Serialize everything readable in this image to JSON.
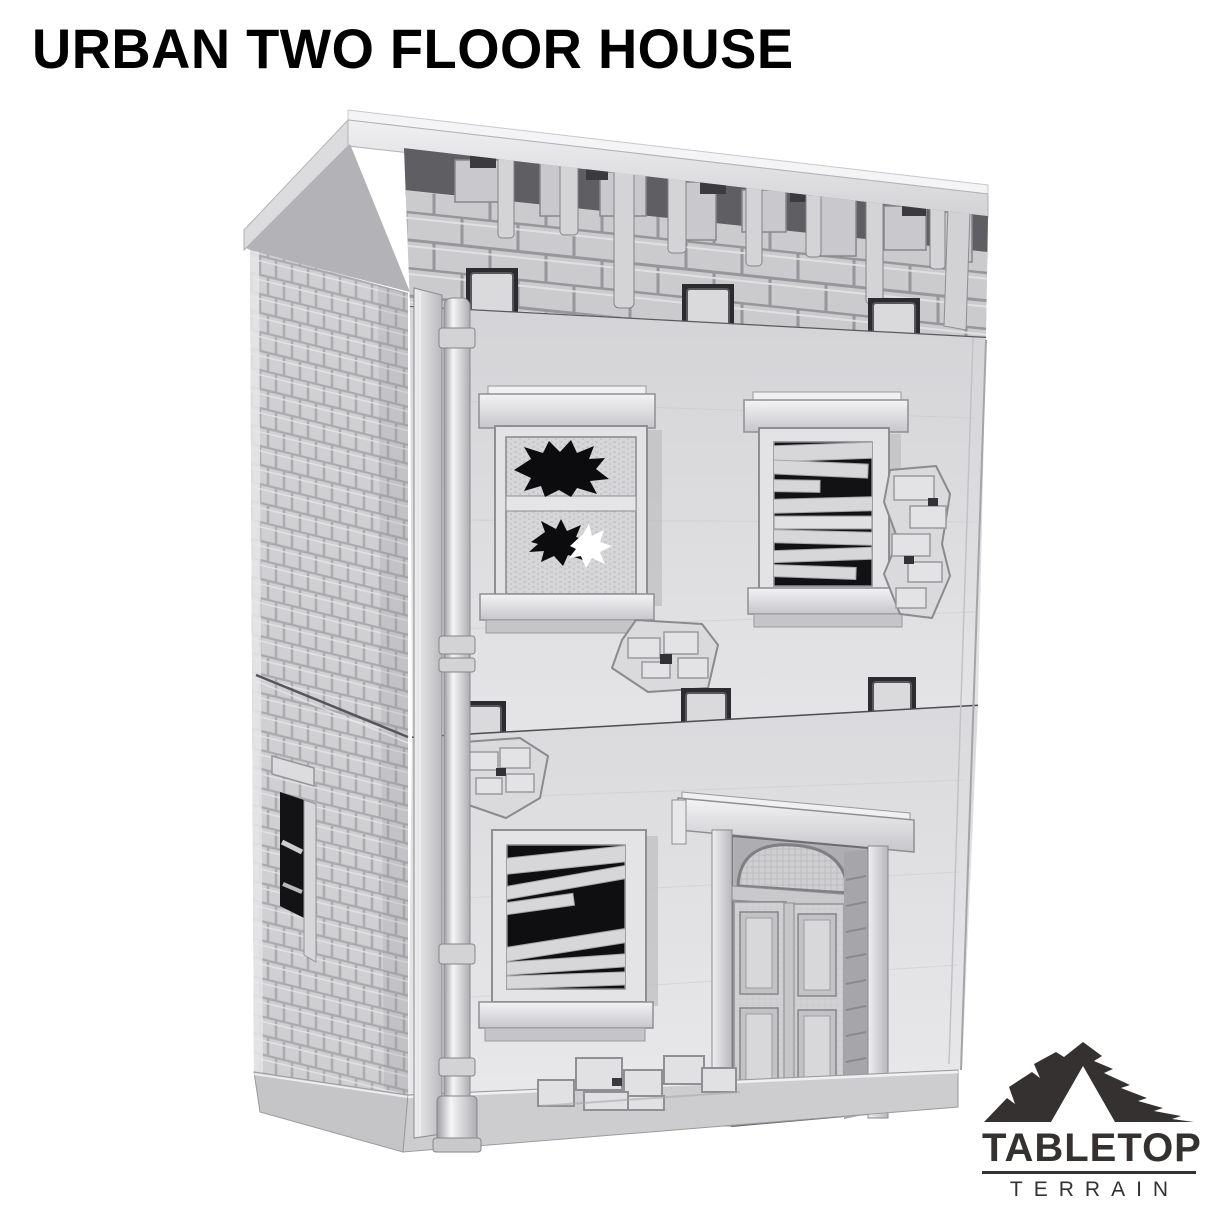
{
  "page": {
    "background_color": "#ffffff",
    "width": 1214,
    "height": 1214
  },
  "title": {
    "text": "URBAN TWO FLOOR HOUSE",
    "color": "#000000"
  },
  "product_image": {
    "description": "Grey 3D printed tabletop terrain model of a ruined two-storey urban house with damaged brick parapet, a shattered glass window, boarded-up windows, an arched panelled double door, a corner drainpipe, brick side wall and rubble, photographed on a white background",
    "material_color": "#d6d6d9",
    "shadow_color": "#9a9a9e",
    "opening_color": "#0f0f11",
    "features": [
      "damaged-parapet",
      "broken-glass-window",
      "boarded-window-upper",
      "boarded-window-ground",
      "arched-double-door",
      "drainpipe",
      "brick-side-wall",
      "side-vent-window",
      "wall-damage-patches",
      "rubble-pile",
      "floor-connection-tabs"
    ]
  },
  "logo": {
    "brand": "TABLETOP",
    "sub_brand": "TERRAIN",
    "color": "#353130",
    "icon": "mountain-peaks"
  }
}
